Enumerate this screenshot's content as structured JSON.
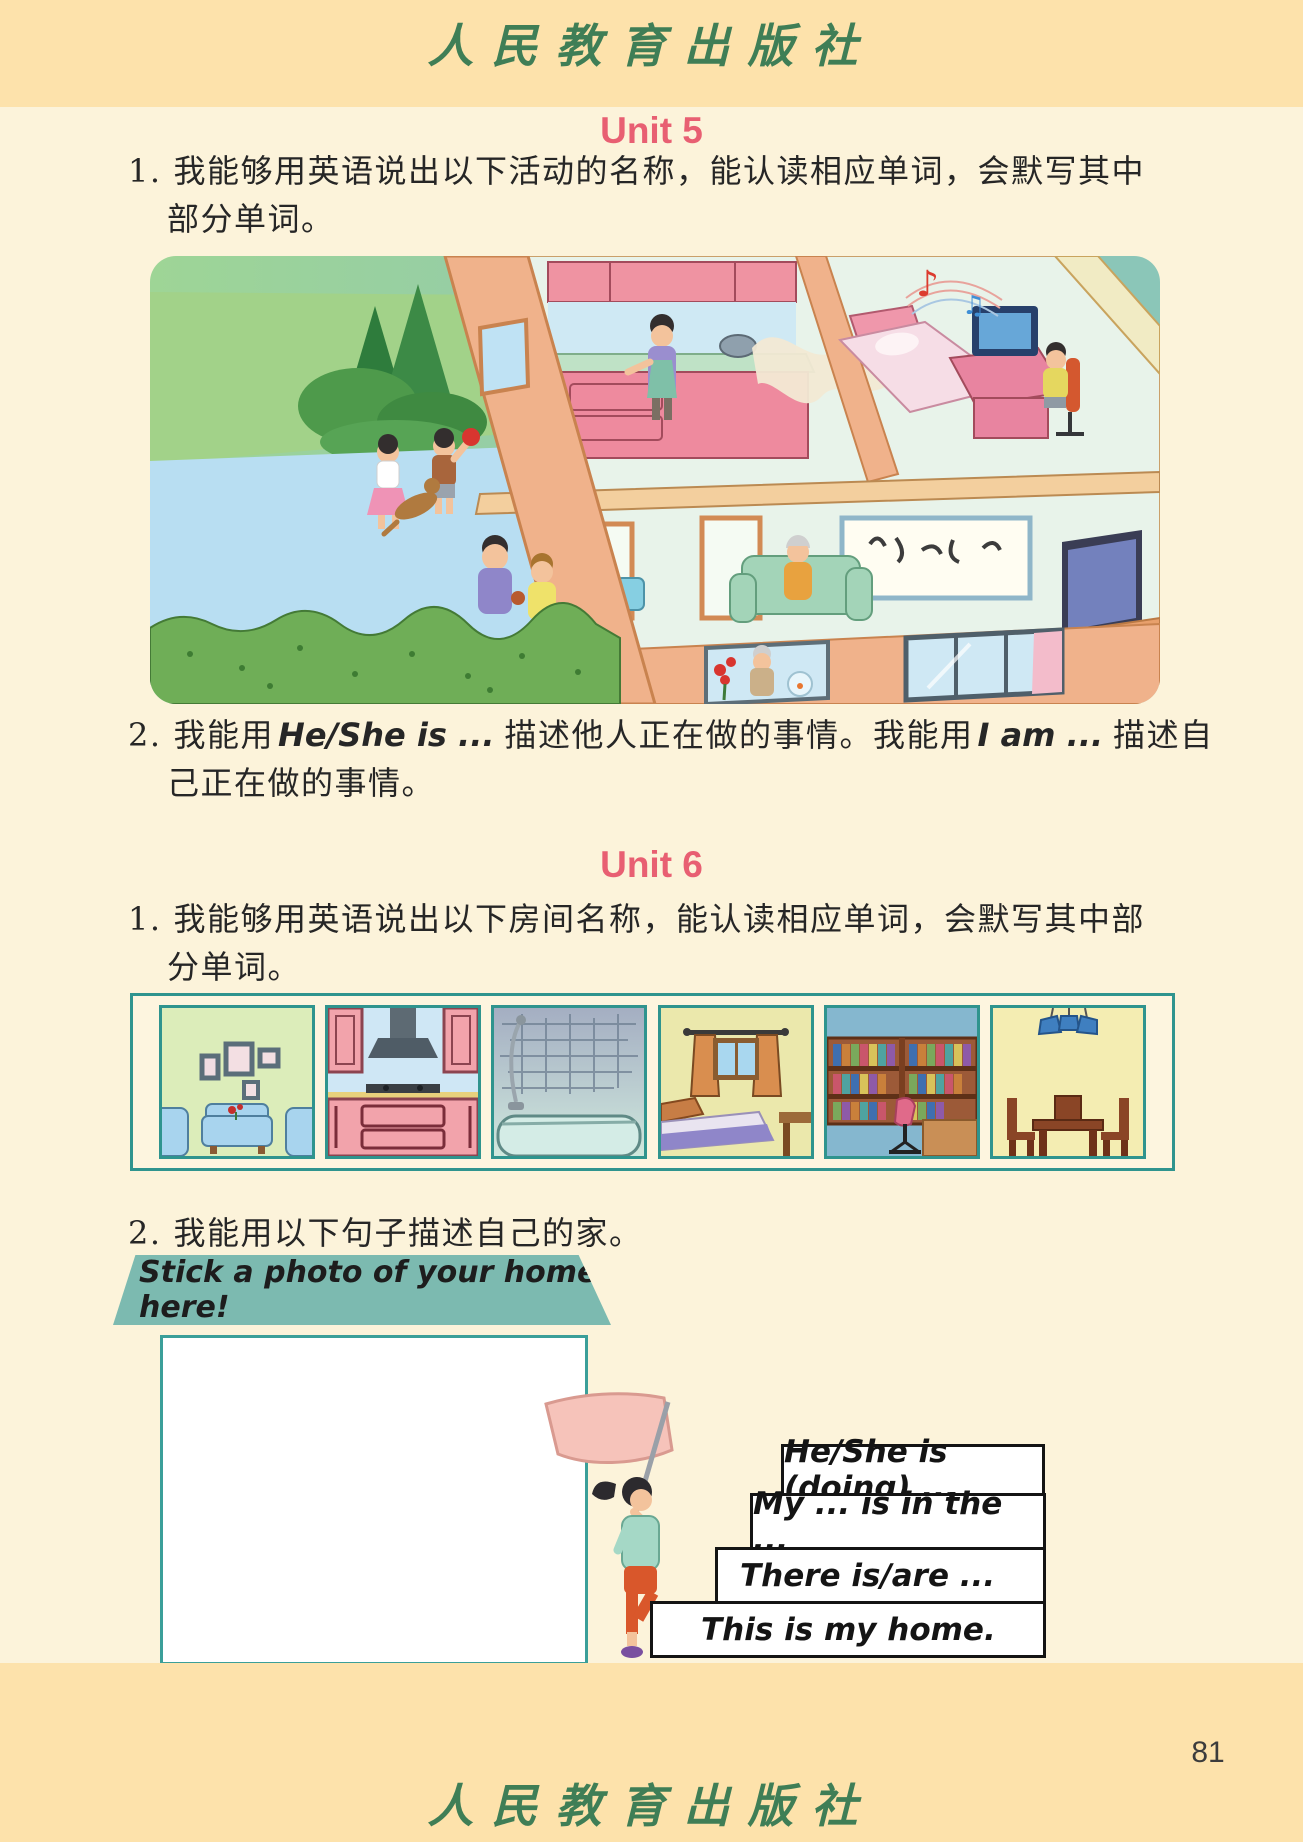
{
  "publisher": {
    "name": "人民教育出版社"
  },
  "page": {
    "number": "81"
  },
  "unit5": {
    "title": "Unit 5",
    "item1": {
      "num": "1.",
      "line1": "我能够用英语说出以下活动的名称，能认读相应单词，会默写其中",
      "line2": "部分单词。"
    },
    "item2": {
      "num": "2.",
      "zh1": "我能用",
      "en1": "He/She is ...",
      "zh2": "描述他人正在做的事情。我能用",
      "en2": "I am ...",
      "zh3": "描述自",
      "line2": "己正在做的事情。"
    },
    "illustration": {
      "scene": "cutaway house with family activities",
      "activities": [
        "cooking",
        "listening to music",
        "cleaning the floor",
        "watching TV",
        "playing with a dog",
        "gardening",
        "feeding goldfish"
      ]
    }
  },
  "unit6": {
    "title": "Unit 6",
    "item1": {
      "num": "1.",
      "line1": "我能够用英语说出以下房间名称，能认读相应单词，会默写其中部",
      "line2": "分单词。"
    },
    "item2": {
      "num": "2.",
      "text": "我能用以下句子描述自己的家。"
    },
    "rooms": [
      "living room",
      "kitchen",
      "bathroom",
      "bedroom",
      "study",
      "dining room"
    ],
    "banner": "Stick a photo of your home here!",
    "sentences": [
      "He/She is (doing) ...",
      "My ... is in the ...",
      "There is/are ...",
      "This is my home."
    ]
  }
}
